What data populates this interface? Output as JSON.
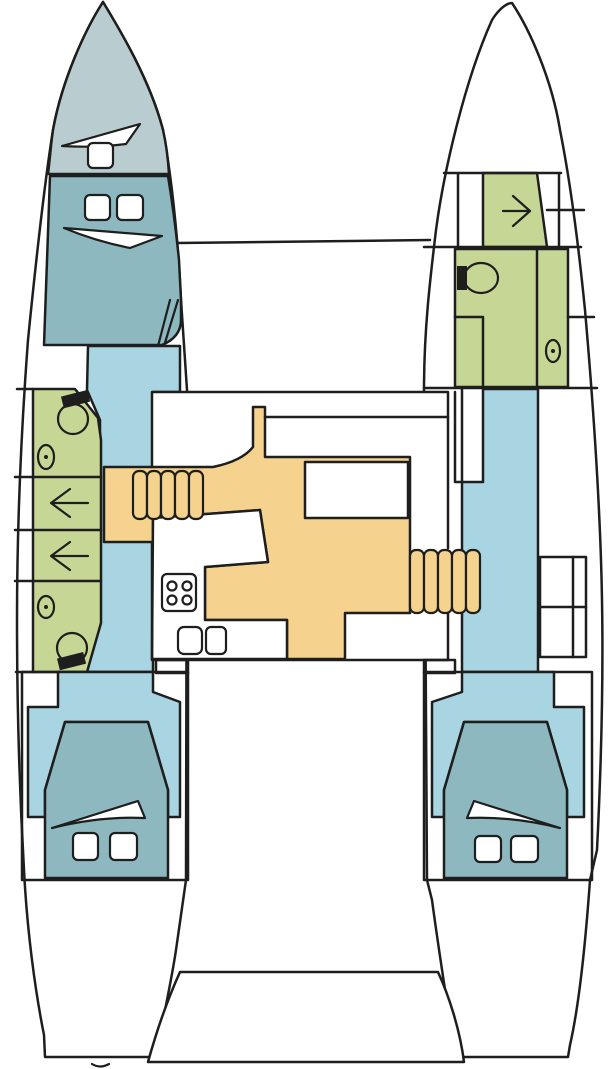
{
  "title": "Catamaran deck floor plan",
  "colors": {
    "outline": "#1e1e1e",
    "hull": "#ffffff",
    "forepeak": "#b9cdd1",
    "berth": "#8db8c0",
    "walkway": "#a9d5e3",
    "wet_room": "#c6d795",
    "saloon_floor": "#f5d38e",
    "white": "#ffffff",
    "black": "#1e1e1e"
  },
  "fixtures": {
    "toilets": 3,
    "hand_basins": 3,
    "shower_stalls": 3,
    "stove_burners": 4,
    "galley_sinks": 2,
    "double_berths": 3,
    "stair_flights": 2,
    "port_shower_arrow_direction": "left",
    "starboard_shower_arrow_direction": "right"
  }
}
